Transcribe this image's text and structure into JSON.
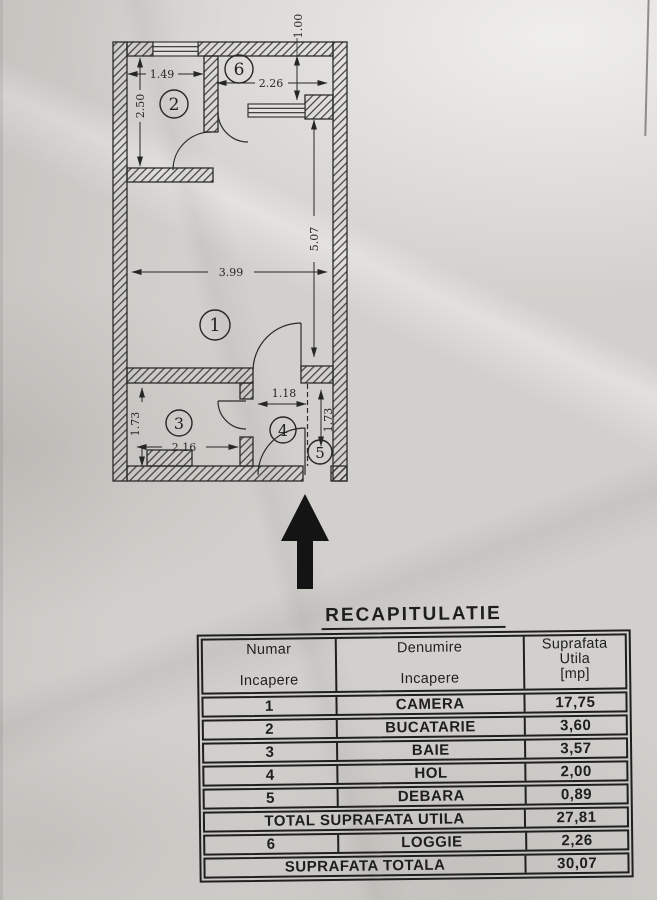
{
  "floor_plan": {
    "room_numbers": {
      "r1": "1",
      "r2": "2",
      "r3": "3",
      "r4": "4",
      "r5": "5",
      "r6": "6"
    },
    "dimensions": {
      "room1_width": "3.99",
      "room1_height": "5.07",
      "room2_width": "1.49",
      "room2_height": "2.50",
      "room3_width": "2.16",
      "room3_height": "1.73",
      "room4_width": "1.18",
      "room5_height": "1.73",
      "room6_width": "2.26",
      "room6_depth": "1.00"
    }
  },
  "recap": {
    "title": "RECAPITULATIE",
    "headers": {
      "col1": [
        "Numar",
        "Incapere"
      ],
      "col2": [
        "Denumire",
        "Incapere"
      ],
      "col3": [
        "Suprafata",
        "Utila",
        "[mp]"
      ]
    },
    "rows": [
      {
        "num": "1",
        "name": "CAMERA",
        "area": "17,75"
      },
      {
        "num": "2",
        "name": "BUCATARIE",
        "area": "3,60"
      },
      {
        "num": "3",
        "name": "BAIE",
        "area": "3,57"
      },
      {
        "num": "4",
        "name": "HOL",
        "area": "2,00"
      },
      {
        "num": "5",
        "name": "DEBARA",
        "area": "0,89"
      }
    ],
    "total_utila": {
      "label": "TOTAL SUPRAFATA UTILA",
      "area": "27,81"
    },
    "row6": {
      "num": "6",
      "name": "LOGGIE",
      "area": "2,26"
    },
    "total": {
      "label": "SUPRAFATA TOTALA",
      "area": "30,07"
    }
  }
}
